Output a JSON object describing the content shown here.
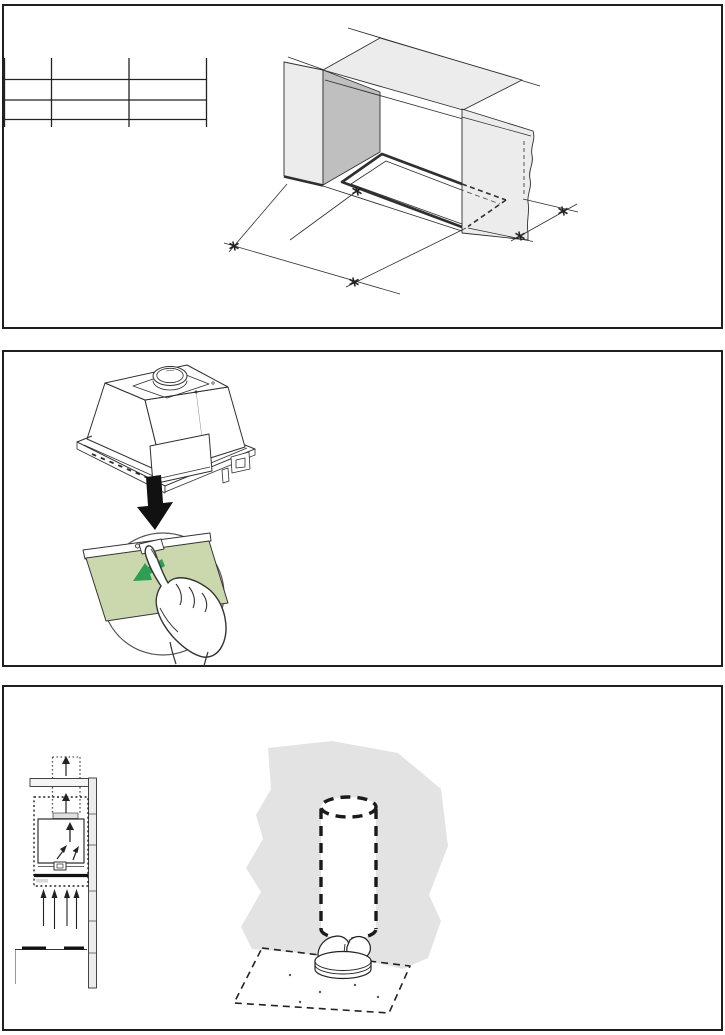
{
  "document": {
    "type": "appliance-installation-manual-page",
    "visible_text": "",
    "panel_count": 3
  },
  "colors": {
    "panel_border": "#1f1f1f",
    "line_art": "#2f2f2f",
    "surface_light_grey": "#ececec",
    "surface_mid_grey": "#bfbfbf",
    "wall_grey": "#e3e3e3",
    "filter_panel_green": "#cbd8ad",
    "arrow_green": "#2f9e55",
    "arrow_black": "#111111",
    "background": "#ffffff"
  },
  "panels": [
    {
      "name": "cabinet-cutout-dimensions",
      "spec_table": {
        "columns": 3,
        "rows": 2,
        "cells": "empty"
      },
      "figure": "isometric-cabinet-opening-with-cutout",
      "dimension_markers": 5
    },
    {
      "name": "hood-insert-filter-removal",
      "figures": [
        "hood-insert-unit",
        "down-arrow",
        "press-filter-latch-detail"
      ]
    },
    {
      "name": "installation-venting",
      "figures": [
        "duct-airflow-schematic",
        "wall-duct-with-non-return-valve"
      ],
      "airflow_arrows": {
        "duct": 2,
        "inside_hood": 3,
        "below_hood": 4
      }
    }
  ]
}
